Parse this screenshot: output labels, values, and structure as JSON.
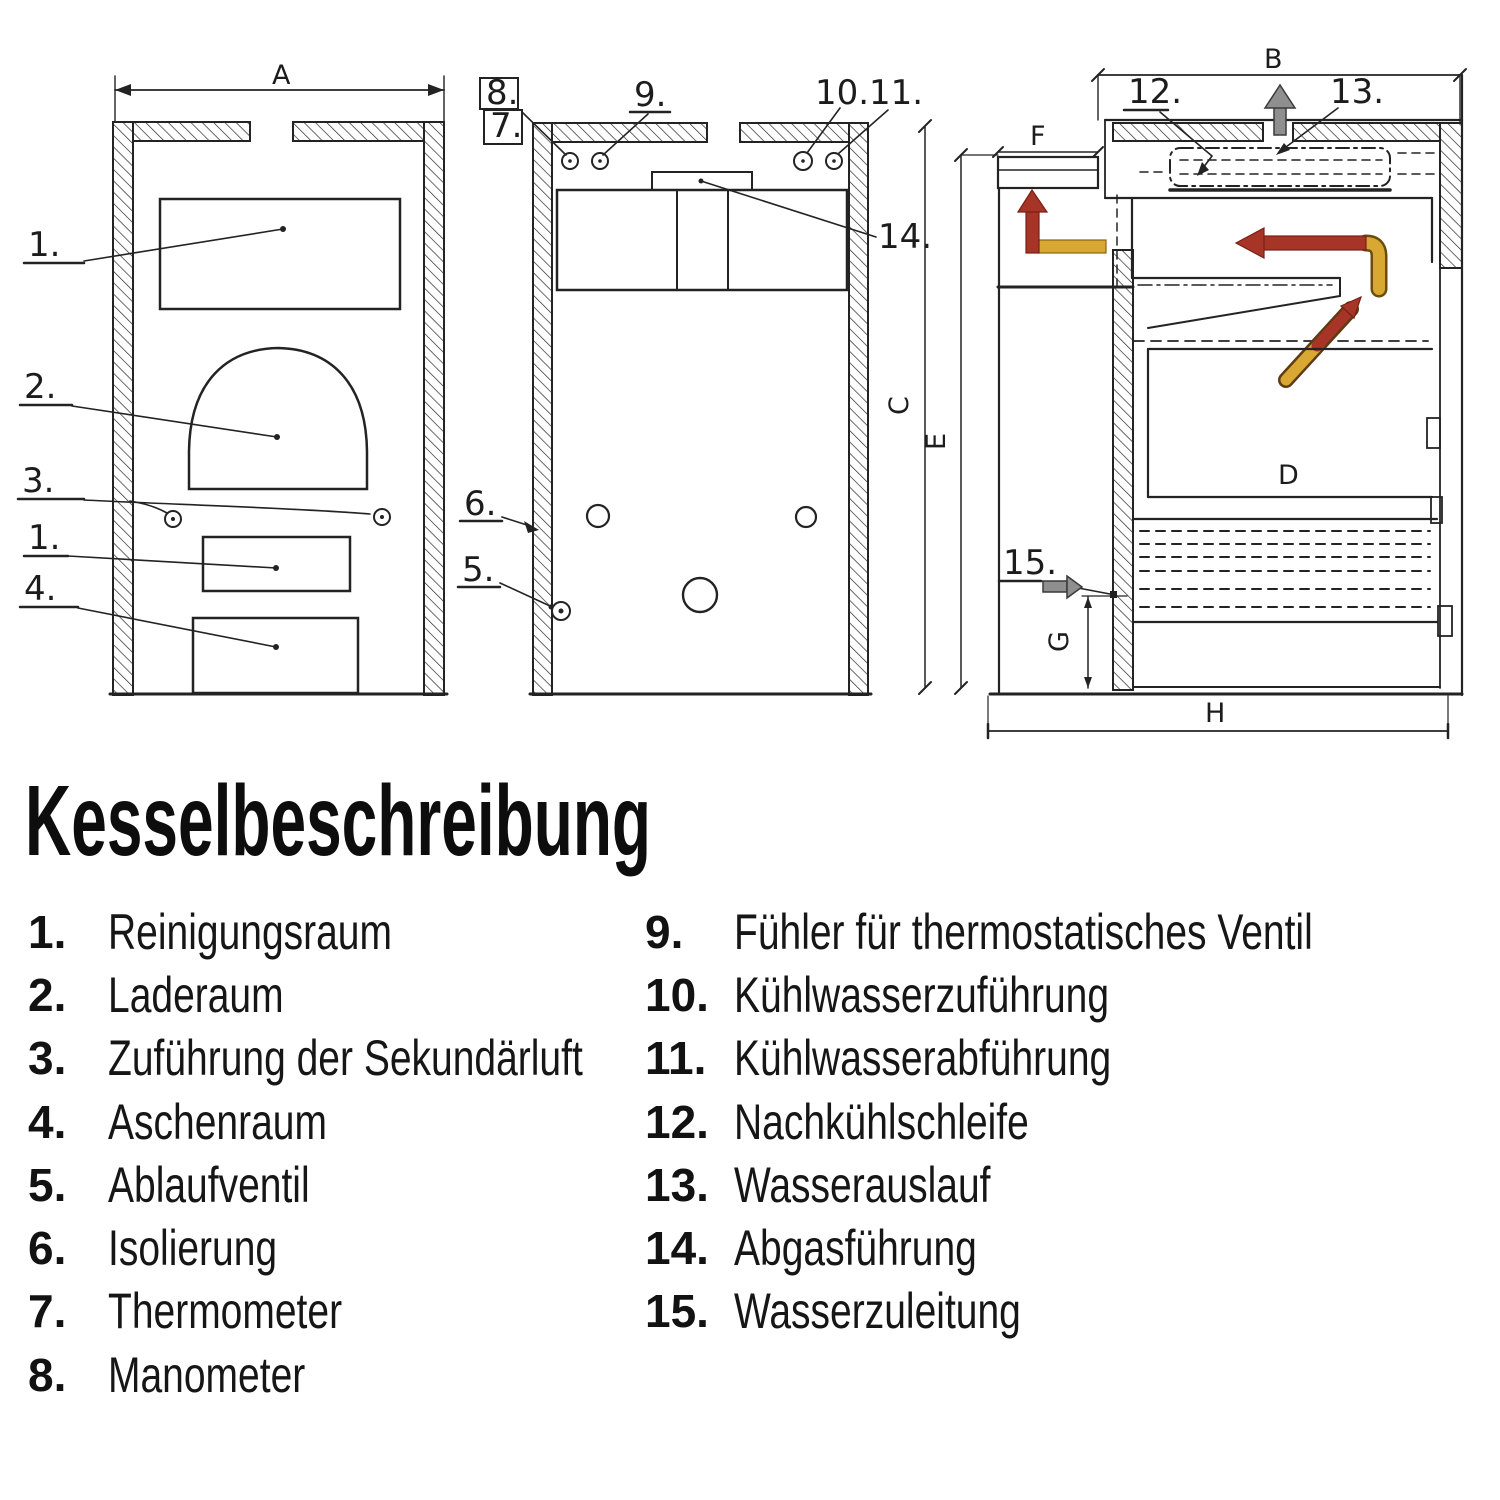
{
  "diagram": {
    "dimensions": {
      "A": "A",
      "B": "B",
      "C": "C",
      "D": "D",
      "E": "E",
      "F": "F",
      "G": "G",
      "H": "H"
    },
    "callouts": {
      "c1": "1.",
      "c1b": "1.",
      "c2": "2.",
      "c3": "3.",
      "c4": "4.",
      "c5": "5.",
      "c6": "6.",
      "c7": "7.",
      "c8": "8.",
      "c9": "9.",
      "c10": "10.",
      "c11": "11.",
      "c12": "12.",
      "c13": "13.",
      "c14": "14.",
      "c15": "15."
    },
    "flow_colors": {
      "hot_gas": "#a63528",
      "warm_gas": "#d9a833",
      "water": "#8f8f8f"
    }
  },
  "legend": {
    "heading": "Kesselbeschreibung",
    "items_left": [
      {
        "num": "1.",
        "label": "Reinigungsraum"
      },
      {
        "num": "2.",
        "label": "Laderaum"
      },
      {
        "num": "3.",
        "label": "Zuführung der Sekundärluft"
      },
      {
        "num": "4.",
        "label": "Aschenraum"
      },
      {
        "num": "5.",
        "label": "Ablaufventil"
      },
      {
        "num": "6.",
        "label": "Isolierung"
      },
      {
        "num": "7.",
        "label": "Thermometer"
      },
      {
        "num": "8.",
        "label": "Manometer"
      }
    ],
    "items_right": [
      {
        "num": "9.",
        "label": "Fühler für thermostatisches Ventil"
      },
      {
        "num": "10.",
        "label": "Kühlwasserzuführung"
      },
      {
        "num": "11.",
        "label": "Kühlwasserabführung"
      },
      {
        "num": "12.",
        "label": "Nachkühlschleife"
      },
      {
        "num": "13.",
        "label": "Wasserauslauf"
      },
      {
        "num": "14.",
        "label": "Abgasführung"
      },
      {
        "num": "15.",
        "label": "Wasserzuleitung"
      }
    ]
  }
}
